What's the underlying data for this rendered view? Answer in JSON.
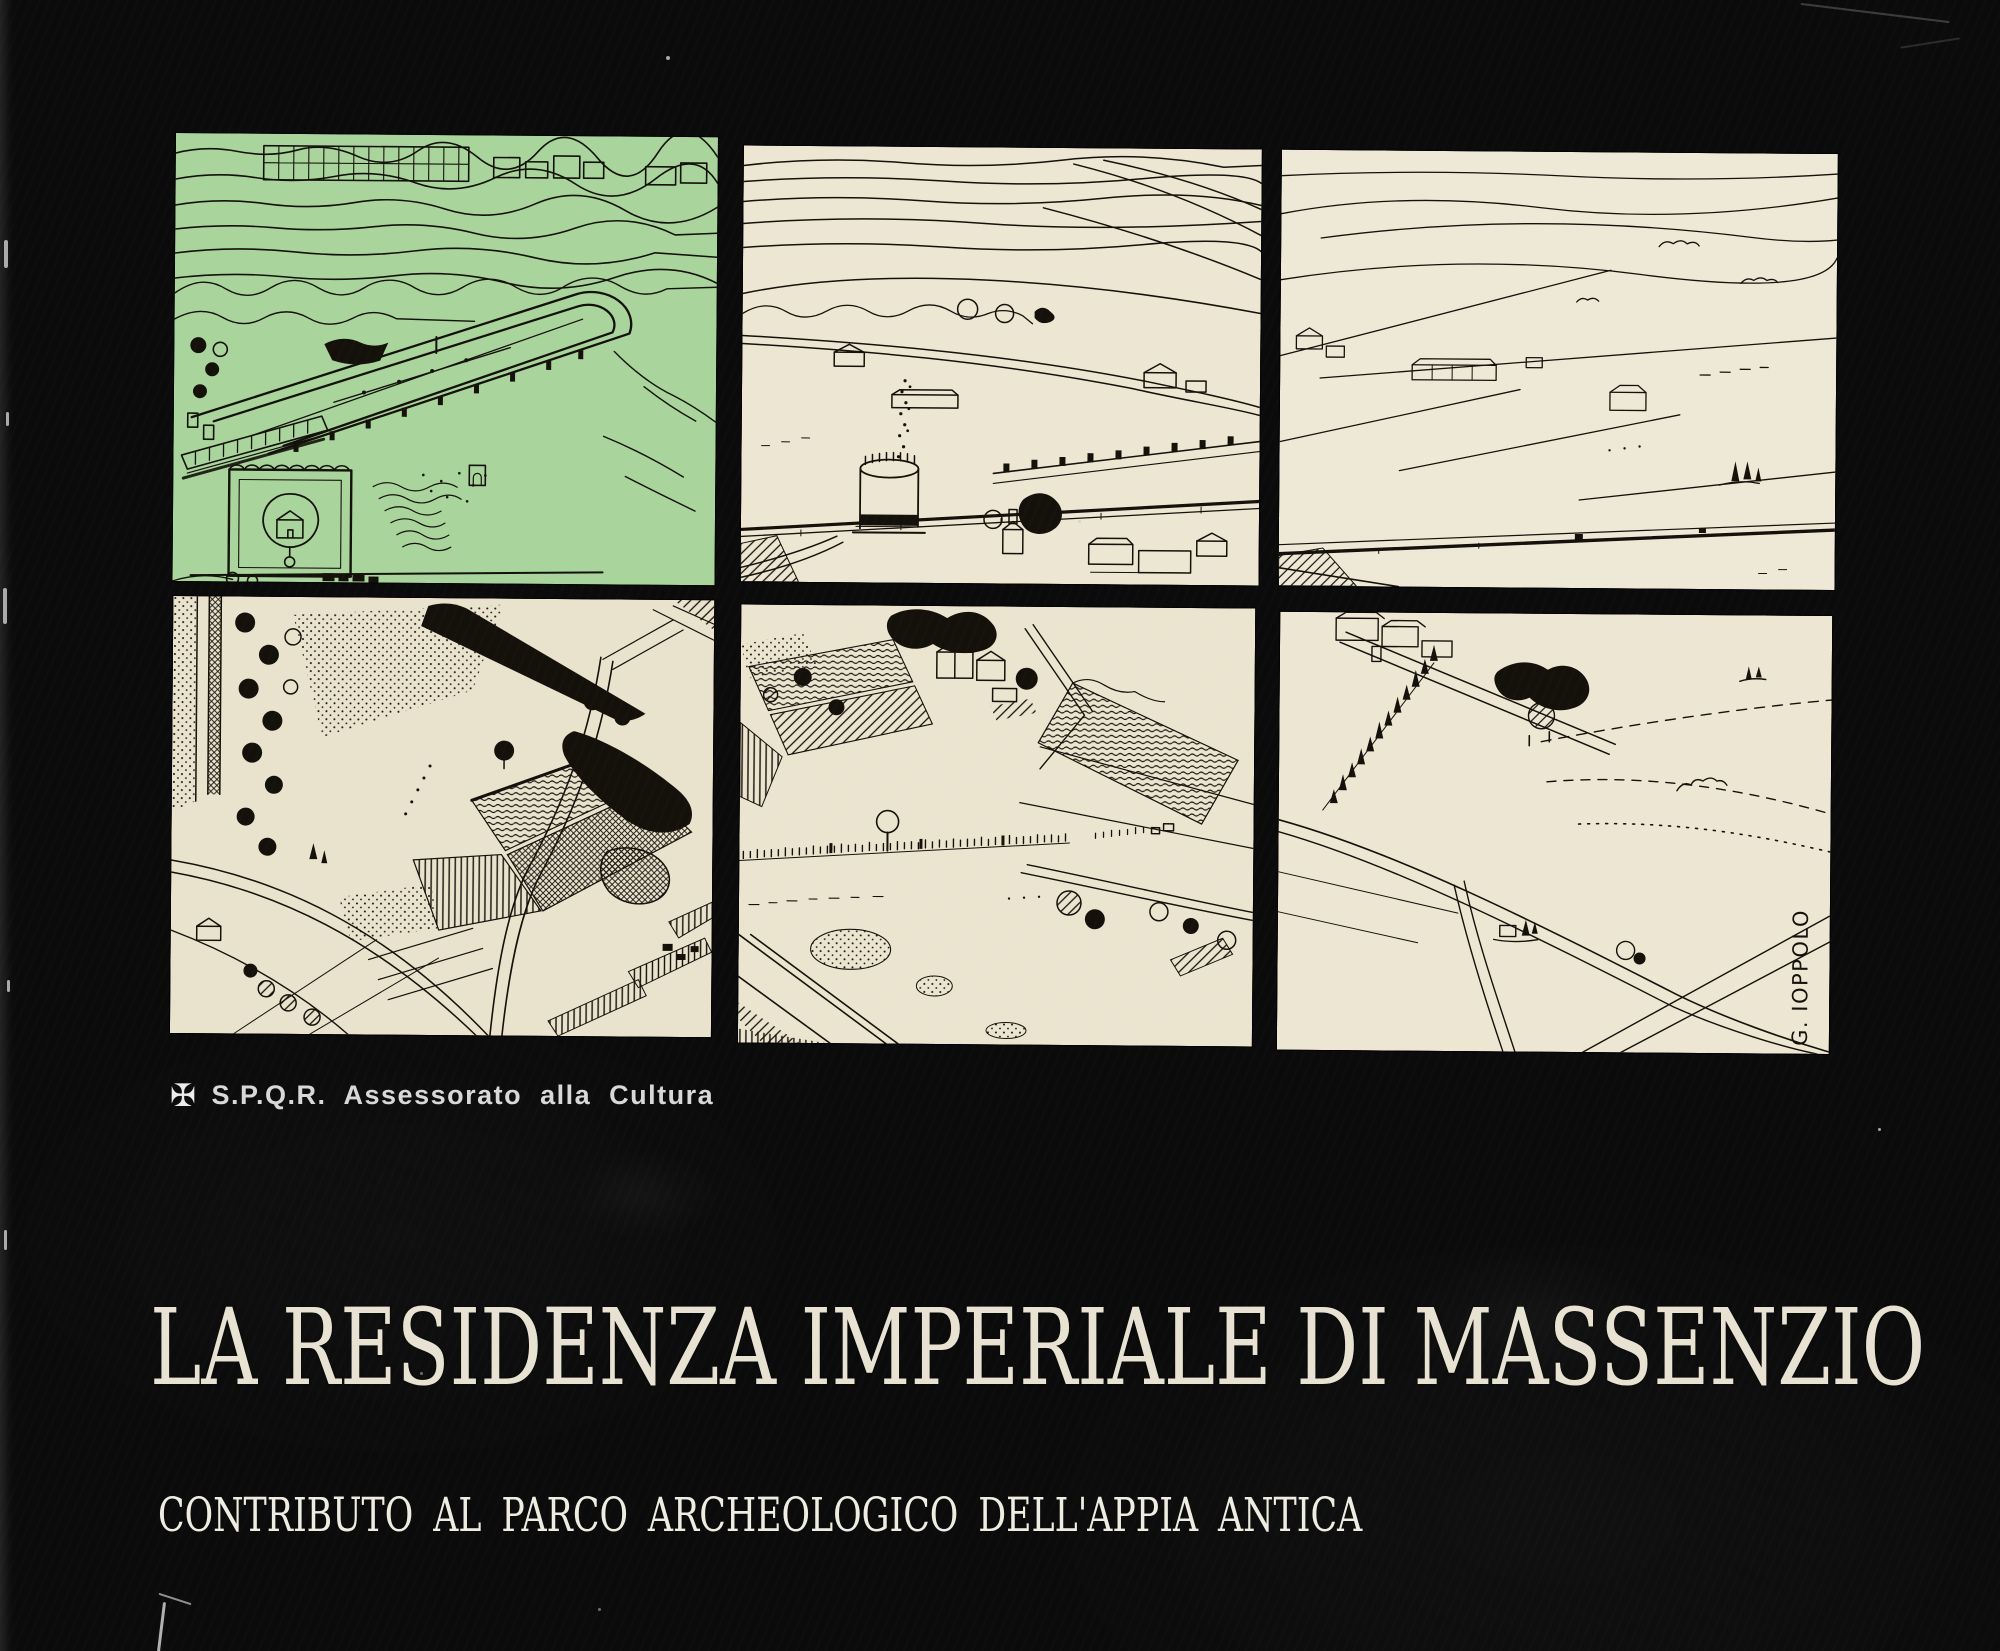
{
  "cover": {
    "publisher": {
      "logo_glyph": "✠",
      "text": "S.P.Q.R.  Assessorato  alla  Cultura"
    },
    "title": "LA RESIDENZA IMPERIALE DI MASSENZIO",
    "subtitle": "CONTRIBUTO AL PARCO ARCHEOLOGICO DELL'APPIA ANTICA",
    "signature": "G. IOPPOLO",
    "colors": {
      "background": "#0b0b0b",
      "paper": "#ece6d2",
      "green_tint": "#a9d49c",
      "ink": "#14110b",
      "title_text": "#e7e2d1",
      "subtitle_text": "#efece1",
      "publisher_text": "#d8d8d8"
    },
    "panels": [
      {
        "name": "circus-of-maxentius-green",
        "label": "Aerial reconstruction drawing of the Circus of Maxentius, green tinted"
      },
      {
        "name": "via-appia-tomb-tower",
        "label": "Countryside drawing with round tomb tower on the Via Appia"
      },
      {
        "name": "open-campagna",
        "label": "Open countryside crossed by the straight Via Appia"
      },
      {
        "name": "cultivated-fields",
        "label": "Dense cultivated fields with winding roads"
      },
      {
        "name": "appia-ruins-line",
        "label": "Fields with a line of small ruins along the Via Appia"
      },
      {
        "name": "sparse-fields-signed",
        "label": "Sparse fields with cypress rows, signed by the artist"
      }
    ]
  }
}
